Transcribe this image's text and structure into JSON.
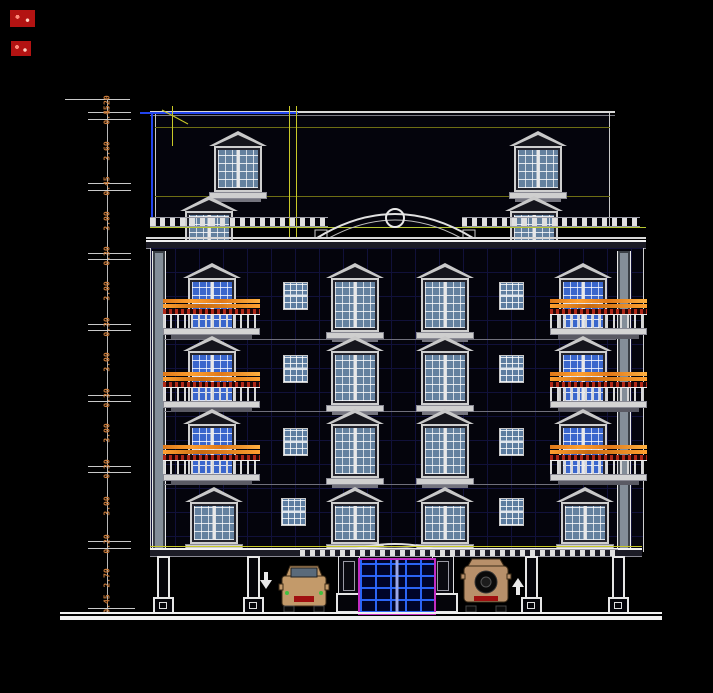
{
  "drawing": {
    "title": "residential building front elevation - CAD drawing",
    "colors": {
      "background": "#000000",
      "line_white": "#e8e8e8",
      "wall_grid_blue": "#11113a",
      "dimension_text_orange": "#c97b3a",
      "balcony_rail_orange": "#ff9a2a",
      "balcony_dash_red": "#b02818",
      "window_glass_steel": "#64819f",
      "window_glass_blue": "#3a66cc",
      "grid_line_yellow": "#d8d820",
      "cornice_yellowgreen": "#b6c832",
      "slab_line_blue": "#2244ee",
      "door_frame_magenta": "#c22cc2",
      "door_grid_blue": "#2d69ff",
      "car_body_tan": "#c39a6a"
    },
    "dimensions": {
      "axis_x": 107,
      "ticks": [
        {
          "y": 99,
          "x1": 65,
          "x2": 130
        },
        {
          "y": 112,
          "x1": 88,
          "x2": 131
        },
        {
          "y": 119,
          "x1": 88,
          "x2": 131
        },
        {
          "y": 183,
          "x1": 88,
          "x2": 131
        },
        {
          "y": 190,
          "x1": 88,
          "x2": 131
        },
        {
          "y": 253,
          "x1": 88,
          "x2": 131
        },
        {
          "y": 259,
          "x1": 88,
          "x2": 131
        },
        {
          "y": 324,
          "x1": 88,
          "x2": 131
        },
        {
          "y": 330,
          "x1": 88,
          "x2": 131
        },
        {
          "y": 395,
          "x1": 88,
          "x2": 131
        },
        {
          "y": 401,
          "x1": 88,
          "x2": 131
        },
        {
          "y": 466,
          "x1": 88,
          "x2": 131
        },
        {
          "y": 472,
          "x1": 88,
          "x2": 131
        },
        {
          "y": 541,
          "x1": 88,
          "x2": 131
        },
        {
          "y": 548,
          "x1": 88,
          "x2": 131
        },
        {
          "y": 608,
          "x1": 88,
          "x2": 135
        }
      ],
      "labels": [
        {
          "y": 105,
          "value": "1.20"
        },
        {
          "y": 115,
          "value": "0.45"
        },
        {
          "y": 151,
          "value": "3.60"
        },
        {
          "y": 186,
          "value": "0.45"
        },
        {
          "y": 221,
          "value": "3.00"
        },
        {
          "y": 256,
          "value": "0.30"
        },
        {
          "y": 291,
          "value": "3.00"
        },
        {
          "y": 327,
          "value": "0.30"
        },
        {
          "y": 362,
          "value": "3.00"
        },
        {
          "y": 398,
          "value": "0.30"
        },
        {
          "y": 433,
          "value": "3.00"
        },
        {
          "y": 469,
          "value": "0.30"
        },
        {
          "y": 506,
          "value": "3.00"
        },
        {
          "y": 544,
          "value": "0.20"
        },
        {
          "y": 578,
          "value": "2.70"
        },
        {
          "y": 604,
          "value": "0.45"
        }
      ]
    },
    "elements": {
      "ramp_arrow_left": "down",
      "ramp_arrow_right": "up",
      "cars": [
        "suv-front-view",
        "suv-rear-view"
      ],
      "ornament": "circle-medallion-in-arched-pediment"
    }
  }
}
